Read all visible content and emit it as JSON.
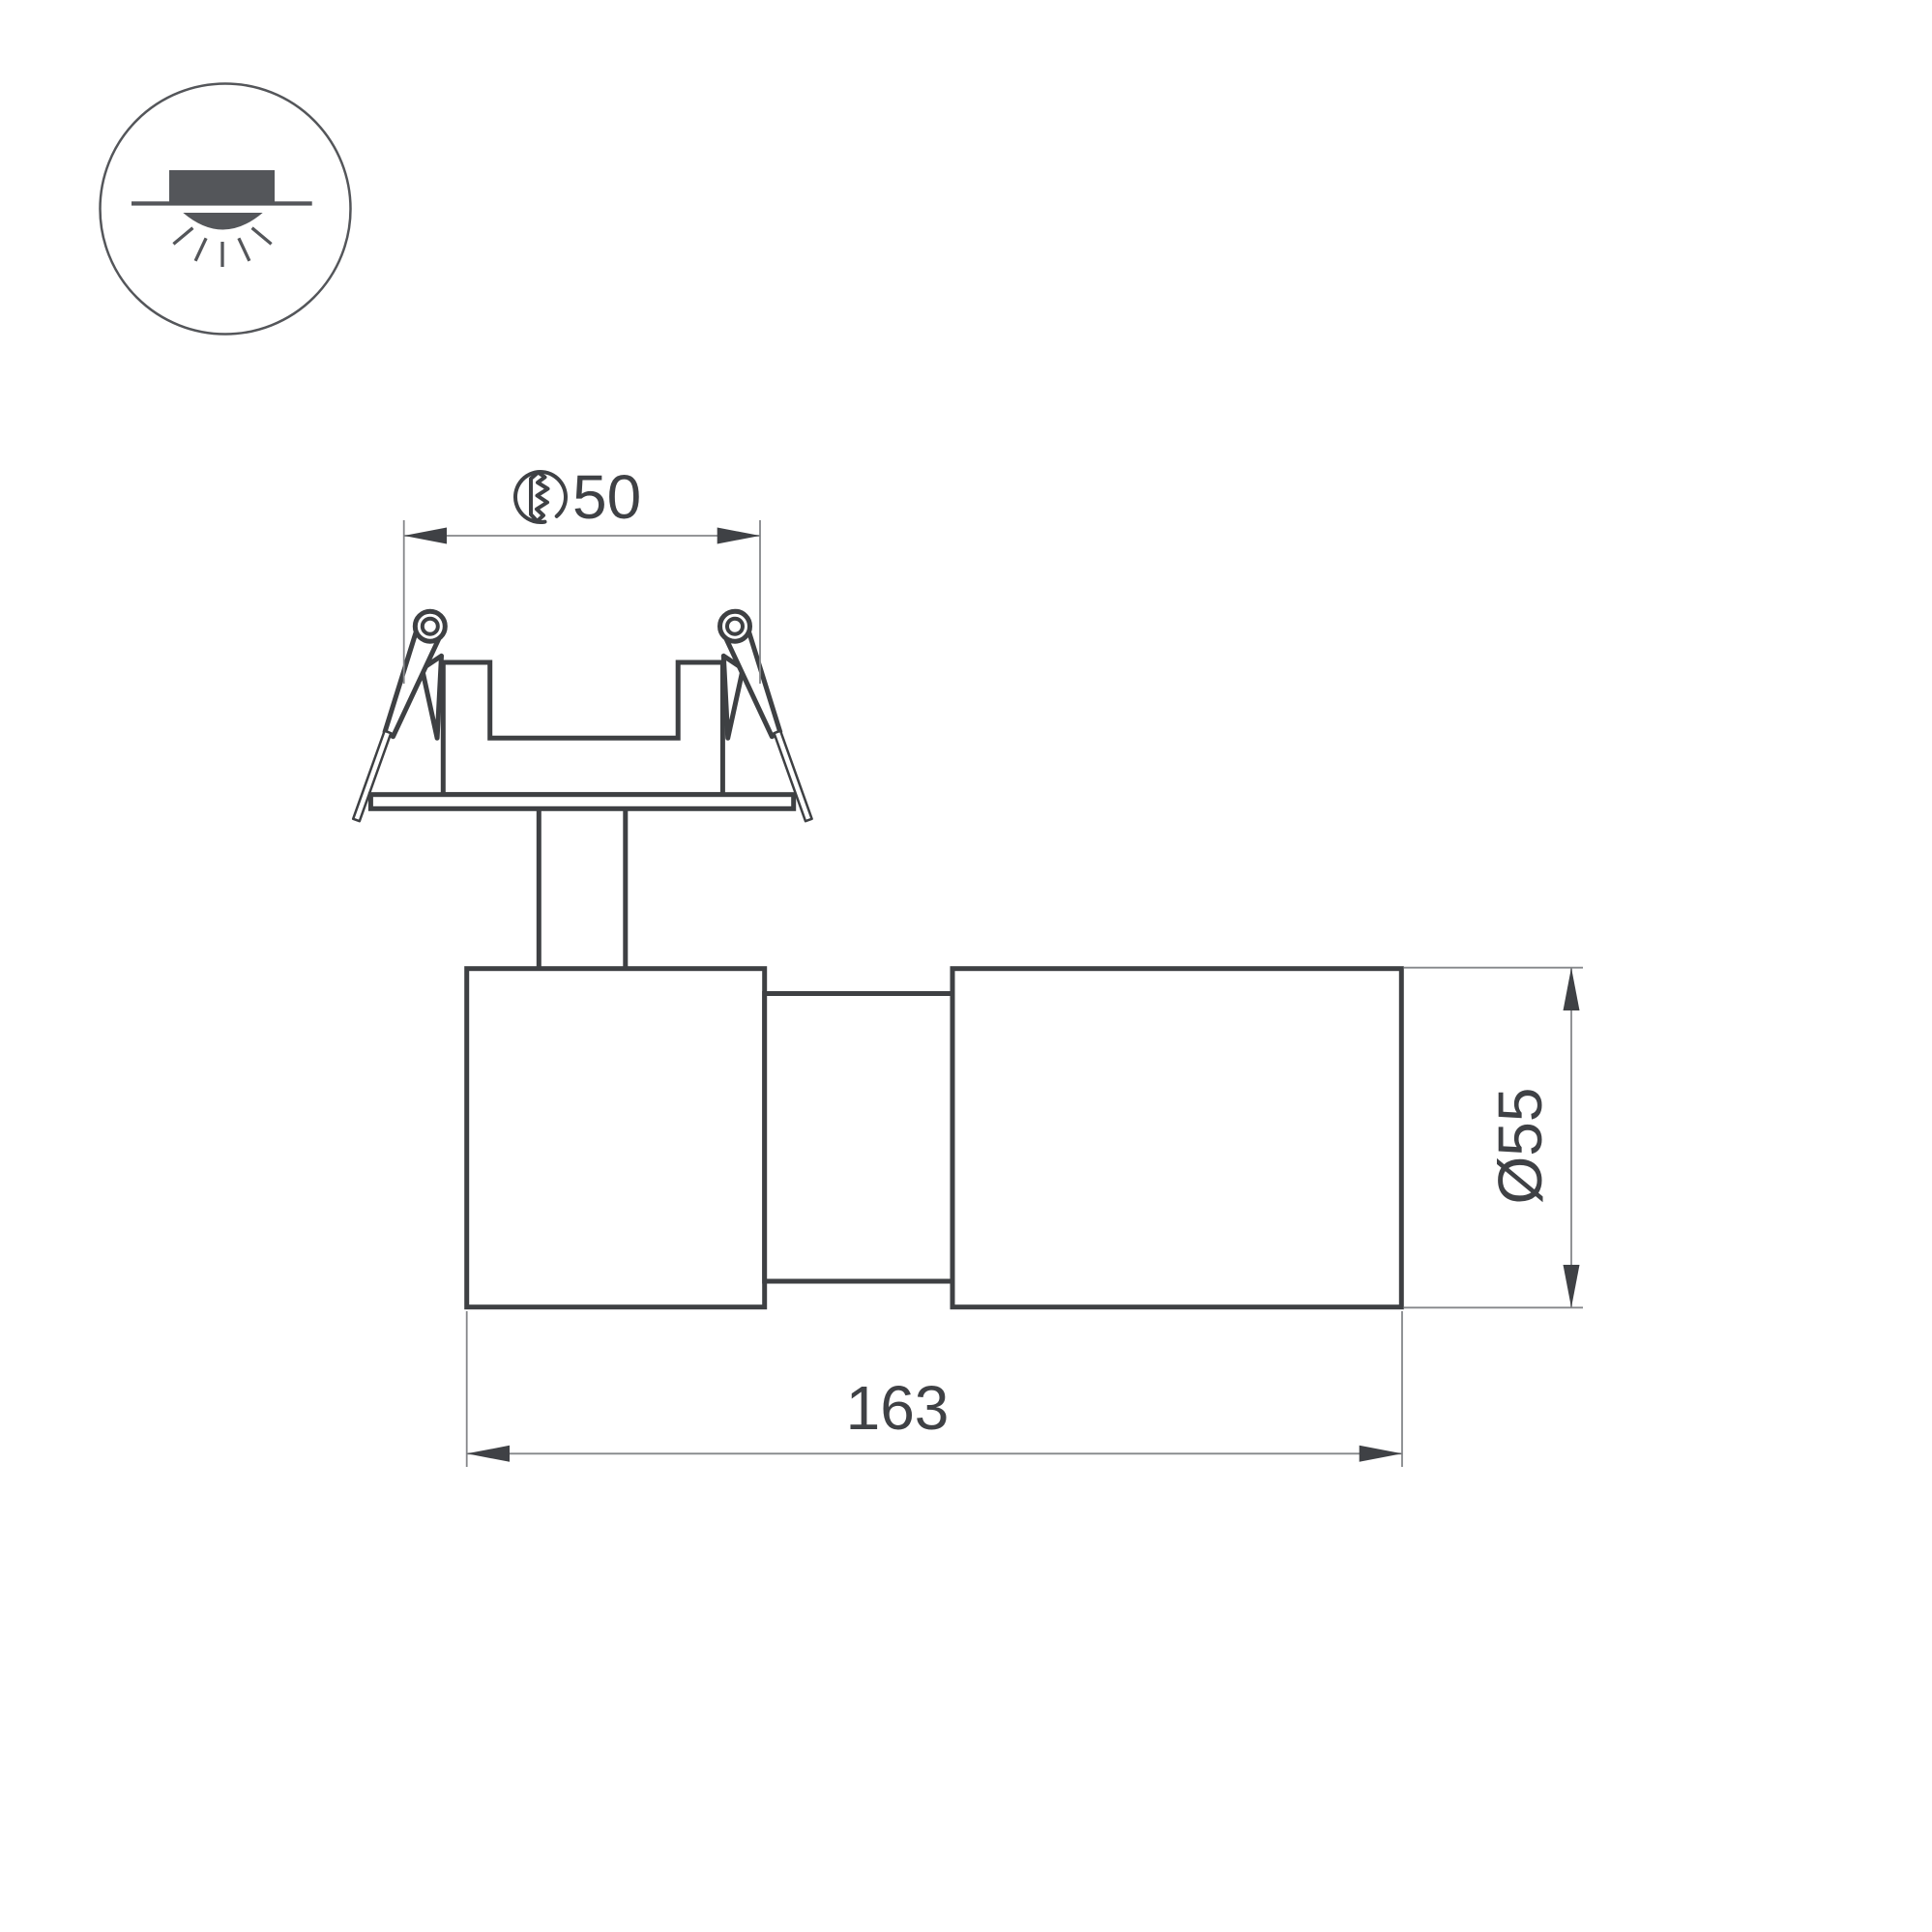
{
  "drawing": {
    "background": "#ffffff",
    "outline_color": "#3e4043",
    "dim_line_color": "#85878a",
    "dim_text_color": "#3f4145",
    "icon_color": "#54565a",
    "dimensions": {
      "cutout_diameter": "50",
      "body_diameter": "Ø55",
      "overall_length": "163"
    },
    "icons": {
      "product_type": "recessed-downlight-icon",
      "cutout_symbol": "hole-cutout-icon"
    }
  }
}
